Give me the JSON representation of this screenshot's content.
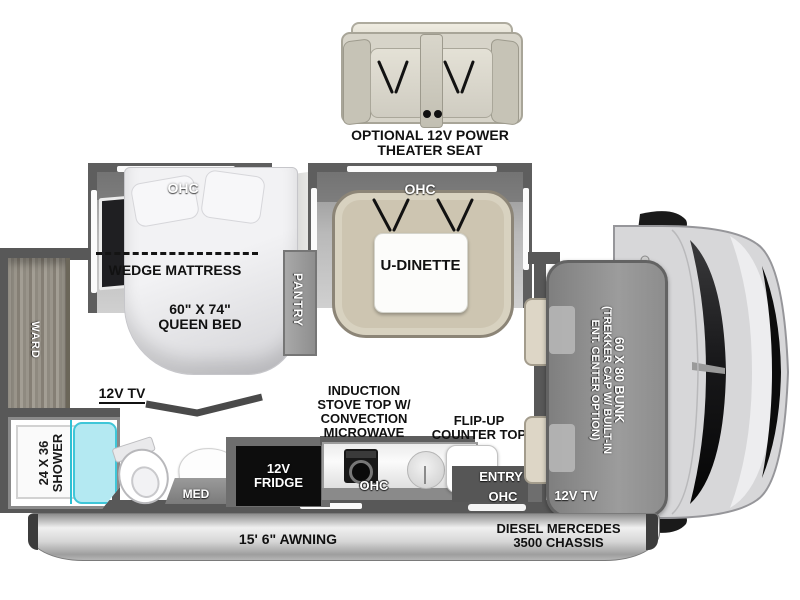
{
  "theater_seat": {
    "caption_line1": "OPTIONAL 12V POWER",
    "caption_line2": "THEATER SEAT"
  },
  "slides": {
    "bedroom_ohc": "OHC",
    "dinette_ohc": "OHC"
  },
  "dinette": {
    "label": "U-DINETTE"
  },
  "bedroom": {
    "wedge_mattress": "WEDGE MATTRESS",
    "bed_size_line1": "60\" X 74\"",
    "bed_size_line2": "QUEEN BED",
    "pantry": "PANTRY",
    "tv": "12V TV"
  },
  "bathroom": {
    "ward": "WARD",
    "shower_size": "24 X 36",
    "shower": "SHOWER",
    "med": "MED"
  },
  "kitchen": {
    "fridge_line1": "12V",
    "fridge_line2": "FRIDGE",
    "appliance_line1": "INDUCTION",
    "appliance_line2": "STOVE TOP W/",
    "appliance_line3": "CONVECTION",
    "appliance_line4": "MICROWAVE",
    "ohc": "OHC",
    "flip_counter_line1": "FLIP-UP",
    "flip_counter_line2": "COUNTER TOP"
  },
  "entry": {
    "label": "ENTRY",
    "ohc": "OHC"
  },
  "cab": {
    "bunk_line1": "60 X 80 BUNK",
    "bunk_line2": "(TREKKER CAP W/ BUILT-IN",
    "bunk_line3": "ENT. CENTER OPTION)",
    "tv": "12V TV"
  },
  "chassis_bar": {
    "awning": "15' 6\" AWNING",
    "chassis_line1": "DIESEL MERCEDES",
    "chassis_line2": "3500 CHASSIS"
  },
  "colors": {
    "floor": "#dcc9a2",
    "wall": "#585858",
    "shower_glass": "#b4e9f2",
    "bench": "#cdc5b1",
    "accent_cyan": "#3fc6d8"
  }
}
